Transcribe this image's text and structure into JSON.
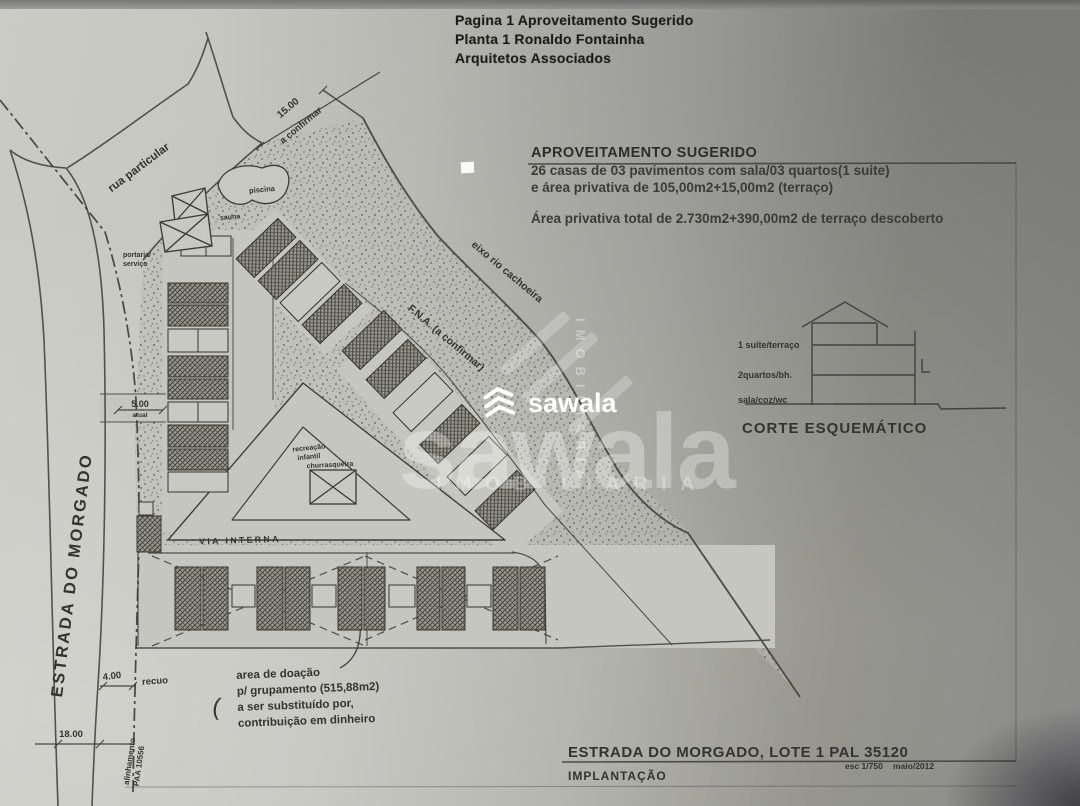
{
  "colors": {
    "paper_light": "#c9c9c3",
    "paper_dark": "#8a8a8a",
    "ink": "#2e2e2c",
    "watermark_white": "#ffffff"
  },
  "header_note": {
    "lines": [
      "Pagina 1 Aproveitamento Sugerido",
      "Planta 1 Ronaldo Fontainha",
      "Arquitetos Associados"
    ]
  },
  "suggestion_block": {
    "title": "APROVEITAMENTO SUGERIDO",
    "lines": [
      "26 casas de 03 pavimentos com sala/03 quartos(1 suite)",
      "e área privativa de 105,00m2+15,00m2 (terraço)"
    ],
    "total_line": "Área privativa total de 2.730m2+390,00m2 de terraço descoberto"
  },
  "section_sketch": {
    "title": "CORTE ESQUEMÁTICO",
    "floor_labels": [
      "1 suite/terraço",
      "2quartos/bh.",
      "sala/coz/wc"
    ]
  },
  "title_block": {
    "project": "ESTRADA DO MORGADO, LOTE 1 PAL 35120",
    "drawing": "IMPLANTAÇÃO",
    "scale": "esc 1/750",
    "date": "maio/2012"
  },
  "plan": {
    "labels": {
      "estrada": "ESTRADA DO MORGADO",
      "rua_particular": "rua particular",
      "piscina": "piscina",
      "sauna": "sauna",
      "portaria_1": "portaria/",
      "portaria_2": "serviço",
      "eixo_rio": "eixo rio cachoeira",
      "fna": "F.N.A. (a confirmar)",
      "recreacao_1": "recreação",
      "recreacao_2": "infantil",
      "churrasqueira": "churrasqueira",
      "via_interna": "VIA INTERNA",
      "paren_mark": "("
    },
    "dimensions": {
      "d15": "15.00",
      "d15_note": "a confirmar",
      "d5": "5.00",
      "d5_note": "atual",
      "d4": "4.00",
      "d4_note": "recuo",
      "d18": "18.00"
    },
    "donation_note": {
      "lines": [
        "area de doação",
        "p/ grupamento (515,88m2)",
        "a ser substituído por,",
        "contribuição em dinheiro"
      ]
    },
    "alignment_note": {
      "lines": [
        "alinhamento",
        "PAA 10556"
      ]
    }
  },
  "watermark": {
    "brand": "sawala",
    "tagline": "IMOBILIÁRIA"
  }
}
